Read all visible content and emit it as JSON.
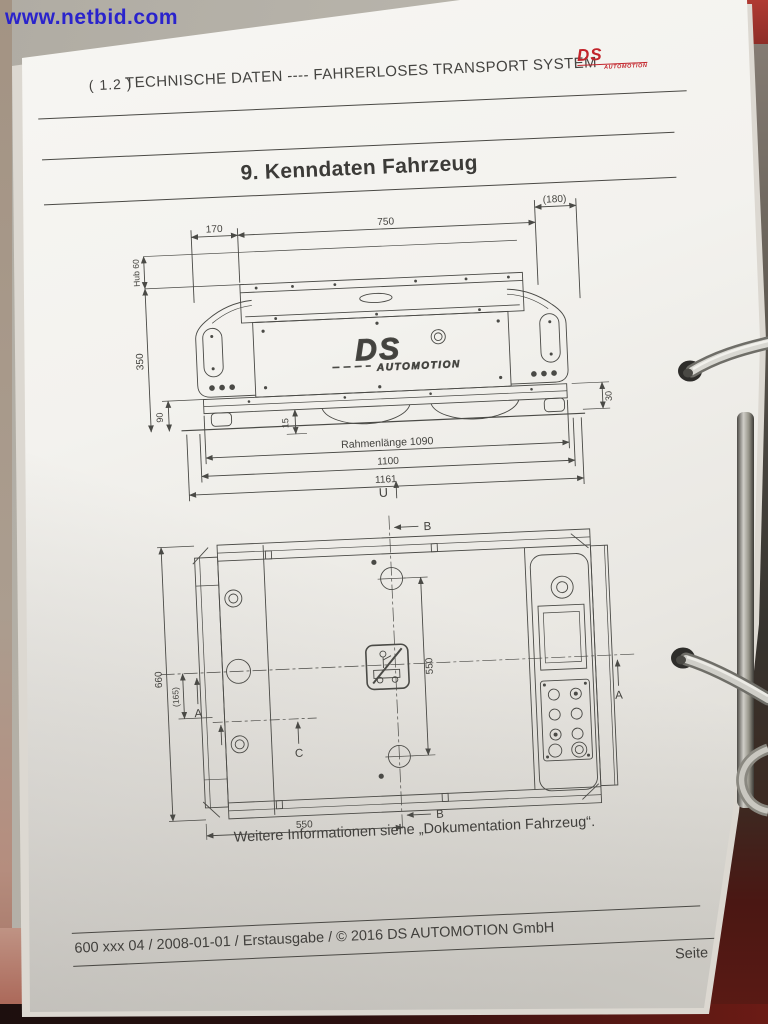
{
  "watermark": "www.netbid.com",
  "header": {
    "chapter": "( 1.2 )",
    "title": "TECHNISCHE DATEN ---- FAHRERLOSES TRANSPORT SYSTEM",
    "logo_main": "DS",
    "logo_sub": "AUTOMOTION"
  },
  "section_title": "9. Kenndaten Fahrzeug",
  "side_view": {
    "dims": {
      "d170": "170",
      "d750": "750",
      "d180": "(180)",
      "hub": "Hub 60",
      "h350": "350",
      "g90": "90",
      "l15": "15",
      "r30": "30",
      "frame": "Rahmenlänge 1090",
      "l1100": "1100",
      "l1161": "1161",
      "u": "U"
    },
    "logo_main": "DS",
    "logo_sub": "AUTOMOTION"
  },
  "top_view": {
    "dims": {
      "b": "B",
      "a": "A",
      "c": "C",
      "w660": "660",
      "off165": "(165)",
      "pin550": "550",
      "half550": "550"
    }
  },
  "caption": "Weitere Informationen siehe „Dokumentation Fahrzeug“.",
  "footer": {
    "left": "600 xxx 04 / 2008-01-01 / Erstausgabe / © 2016 DS AUTOMOTION GmbH",
    "page_number": "Seite 12"
  },
  "colors": {
    "logo_red": "#c2242b",
    "watermark_blue": "#2a23cc"
  }
}
